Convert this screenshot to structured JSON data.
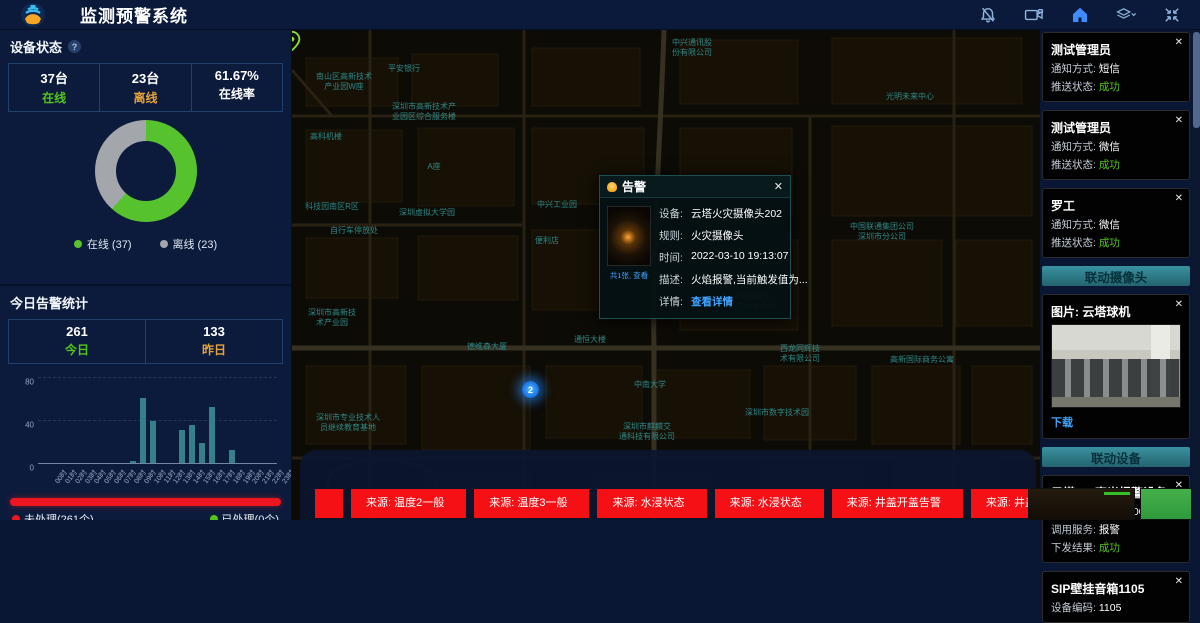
{
  "header": {
    "title": "监测预警系统"
  },
  "icons": {
    "help": "?",
    "close": "✕"
  },
  "panels": {
    "device_status": {
      "title": "设备状态",
      "stats": [
        {
          "value": "37台",
          "label": "在线",
          "color": "#52c41a"
        },
        {
          "value": "23台",
          "label": "离线",
          "color": "#e6a23c"
        },
        {
          "value": "61.67%",
          "label": "在线率",
          "color": "#ffffff"
        }
      ]
    },
    "today": {
      "title": "今日告警统计",
      "stats": [
        {
          "value": "261",
          "label": "今日",
          "color": "#52c41a"
        },
        {
          "value": "133",
          "label": "昨日",
          "color": "#e6a23c"
        }
      ],
      "unhandled_label": "未处理(261个)",
      "handled_label": "已处理(0个)"
    },
    "month": {
      "title": "本月告警统计",
      "stats": [
        {
          "value": "763"
        },
        {
          "value": "1146"
        }
      ]
    }
  },
  "chart_data": [
    {
      "type": "pie",
      "title": "设备状态",
      "labels": [
        "在线",
        "离线"
      ],
      "values": [
        37,
        23
      ],
      "colors": [
        "#56c22d",
        "#a3a7ab"
      ],
      "legend": [
        "在线 (37)",
        "离线 (23)"
      ],
      "legend_position": "bottom",
      "donut": true
    },
    {
      "type": "bar",
      "title": "今日告警统计(按小时)",
      "categories": [
        "00时",
        "01时",
        "02时",
        "03时",
        "04时",
        "05时",
        "06时",
        "07时",
        "08时",
        "09时",
        "10时",
        "11时",
        "12时",
        "13时",
        "14时",
        "15时",
        "16时",
        "17时",
        "18时",
        "19时",
        "20时",
        "21时",
        "22时",
        "23时"
      ],
      "values": [
        0,
        0,
        0,
        0,
        0,
        0,
        0,
        0,
        0,
        2,
        61,
        40,
        0,
        0,
        31,
        36,
        19,
        53,
        0,
        12,
        0,
        0,
        0,
        0
      ],
      "ylim": [
        0,
        80
      ],
      "yticks": [
        0,
        40,
        80
      ],
      "bar_color": "#35808a",
      "grid": true
    }
  ],
  "map": {
    "cluster": {
      "count": "2"
    },
    "alert_popup": {
      "title": "告警",
      "image_caption": "共1张, 查看",
      "rows": [
        {
          "label": "设备:",
          "value": "云塔火灾摄像头202"
        },
        {
          "label": "规则:",
          "value": "火灾摄像头"
        },
        {
          "label": "时间:",
          "value": "2022-03-10 19:13:07"
        },
        {
          "label": "描述:",
          "value": "火焰报警,当前触发值为..."
        },
        {
          "label": "详情:",
          "value": "查看详情",
          "link": true
        }
      ]
    },
    "labels": [
      {
        "x": 400,
        "y": 8,
        "text": "中兴通讯股\n份有限公司"
      },
      {
        "x": 52,
        "y": 42,
        "text": "南山区高新技术\n产业园W座"
      },
      {
        "x": 112,
        "y": 34,
        "text": "平安银行"
      },
      {
        "x": 618,
        "y": 62,
        "text": "光明未来中心"
      },
      {
        "x": 132,
        "y": 72,
        "text": "深圳市高新技术产\n业园区综合服务楼"
      },
      {
        "x": 34,
        "y": 102,
        "text": "高科机楼"
      },
      {
        "x": 142,
        "y": 132,
        "text": "A座"
      },
      {
        "x": 40,
        "y": 172,
        "text": "科技园南区R区"
      },
      {
        "x": 135,
        "y": 178,
        "text": "深圳虚拟大学园"
      },
      {
        "x": 62,
        "y": 196,
        "text": "自行车停放处"
      },
      {
        "x": 265,
        "y": 170,
        "text": "中兴工业园"
      },
      {
        "x": 255,
        "y": 206,
        "text": "便利店"
      },
      {
        "x": 590,
        "y": 192,
        "text": "中国联通集团公司\n深圳市分公司"
      },
      {
        "x": 460,
        "y": 262,
        "text": "深圳国家工\n程实验室大楼"
      },
      {
        "x": 508,
        "y": 314,
        "text": "西龙同辉技\n术有限公司"
      },
      {
        "x": 485,
        "y": 378,
        "text": "深圳市数字技术园"
      },
      {
        "x": 358,
        "y": 350,
        "text": "中南大学"
      },
      {
        "x": 355,
        "y": 392,
        "text": "深圳市麒麟交\n通科技有限公司"
      },
      {
        "x": 195,
        "y": 312,
        "text": "德维森大厦"
      },
      {
        "x": 298,
        "y": 305,
        "text": "通恒大楼"
      },
      {
        "x": 630,
        "y": 325,
        "text": "高新国际商务公寓"
      },
      {
        "x": 40,
        "y": 278,
        "text": "深圳市高新技\n术产业园"
      },
      {
        "x": 56,
        "y": 383,
        "text": "深圳市专业技术人\n员继续教育基地"
      }
    ]
  },
  "notifications": {
    "cards": [
      {
        "name": "测试管理员",
        "rows": [
          {
            "label": "通知方式:",
            "value": "短信"
          },
          {
            "label": "推送状态:",
            "value": "成功",
            "status": true
          }
        ]
      },
      {
        "name": "测试管理员",
        "rows": [
          {
            "label": "通知方式:",
            "value": "微信"
          },
          {
            "label": "推送状态:",
            "value": "成功",
            "status": true
          }
        ]
      },
      {
        "name": "罗工",
        "rows": [
          {
            "label": "通知方式:",
            "value": "微信"
          },
          {
            "label": "推送状态:",
            "value": "成功",
            "status": true
          }
        ]
      }
    ]
  },
  "linked_camera": {
    "header": "联动摄像头",
    "card_title": "图片: 云塔球机",
    "download_label": "下载"
  },
  "linked_device": {
    "header": "联动设备",
    "cards": [
      {
        "title": "云塔307声光报警设备",
        "rows": [
          {
            "label": "设备编码:",
            "value": "ffffff100001ab6c"
          },
          {
            "label": "调用服务:",
            "value": "报警"
          },
          {
            "label": "下发结果:",
            "value": "成功",
            "status": true
          }
        ]
      },
      {
        "title": "SIP壁挂音箱1105",
        "rows": [
          {
            "label": "设备编码:",
            "value": "1105"
          }
        ]
      }
    ]
  },
  "bottom_alerts": [
    "来源: 温度2一般",
    "来源: 温度3一般",
    "来源: 水浸状态",
    "来源: 水浸状态",
    "来源: 井盖开盖告警",
    "来源: 井盖开盖告警"
  ]
}
